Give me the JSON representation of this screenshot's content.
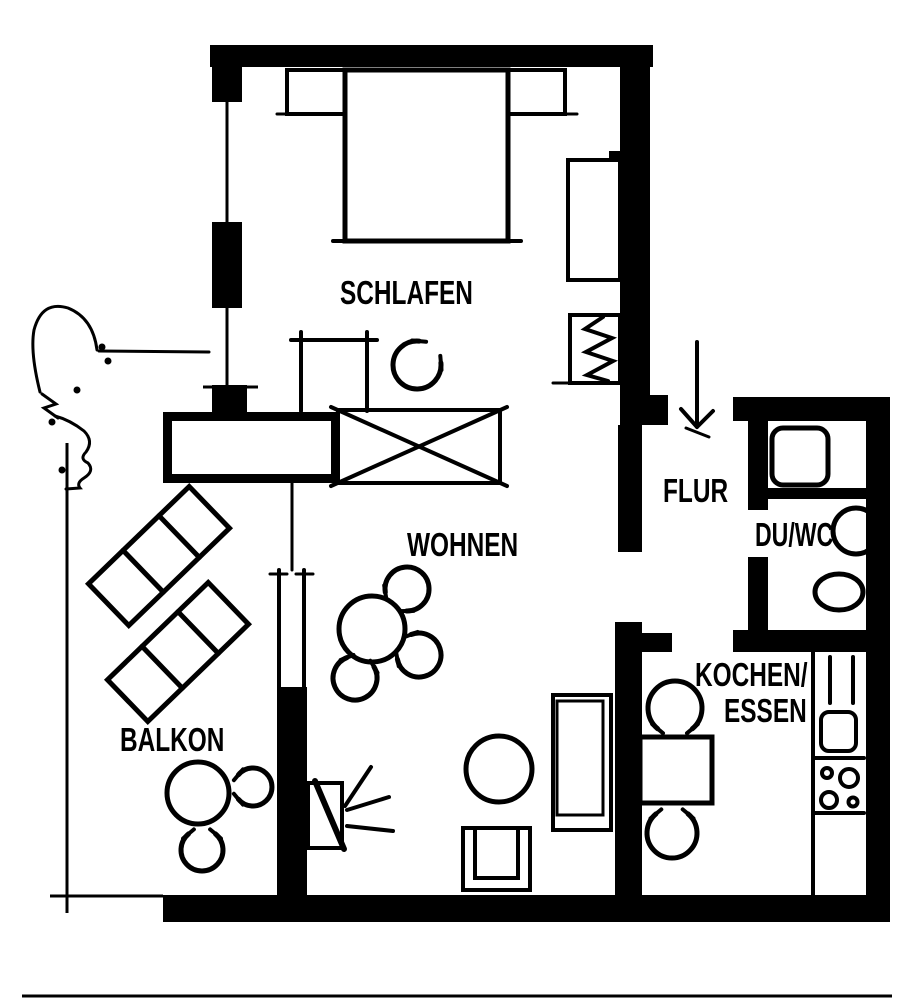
{
  "canvas": {
    "width": 914,
    "height": 1000,
    "ink_color": "#000000",
    "paper_color": "#ffffff",
    "drawing_type": "apartment-floor-plan"
  },
  "rooms": {
    "schlafen": {
      "label": "SCHLAFEN"
    },
    "wohnen": {
      "label": "WOHNEN"
    },
    "balkon": {
      "label": "BALKON"
    },
    "flur": {
      "label": "FLUR"
    },
    "du_wc": {
      "label": "DU/WC"
    },
    "kochen_essen": {
      "label_line1": "KOCHEN/",
      "label_line2": "ESSEN"
    }
  }
}
